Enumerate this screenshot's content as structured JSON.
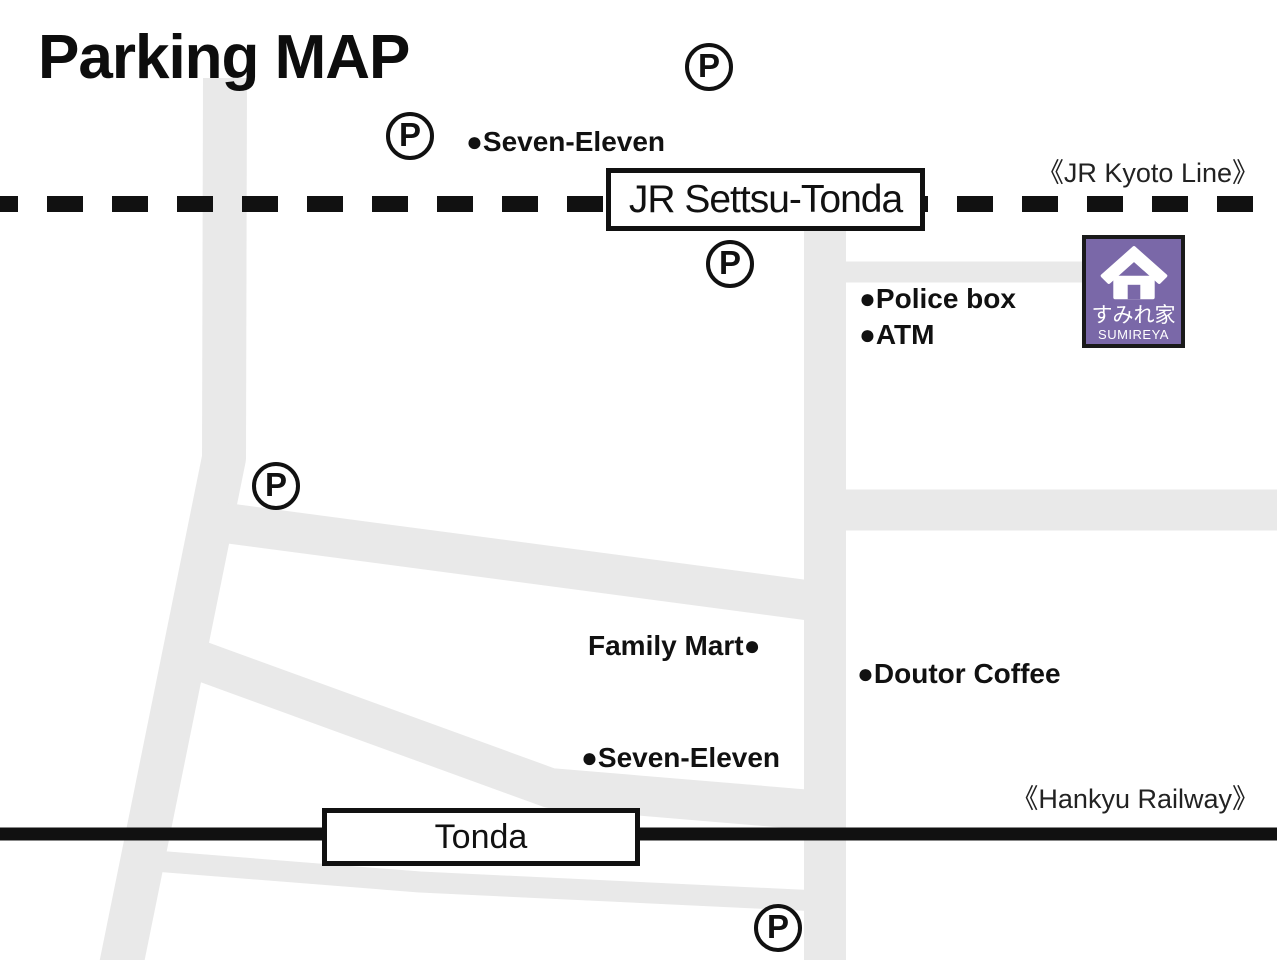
{
  "title": "Parking MAP",
  "jr_line": {
    "name": "《JR Kyoto Line》",
    "station": "JR Settsu-Tonda"
  },
  "hankyu_line": {
    "name": "《Hankyu Railway》",
    "station": "Tonda"
  },
  "parking_letter": "P",
  "landmarks": {
    "seven_eleven_north": "●Seven-Eleven",
    "police_box": "●Police box",
    "atm": "●ATM",
    "family_mart": "Family Mart●",
    "doutor_coffee": "●Doutor Coffee",
    "seven_eleven_south": "●Seven-Eleven"
  },
  "logo": {
    "name_jp": "すみれ家",
    "name_en": "SUMIREYA"
  },
  "colors": {
    "road": "#e9e9e9",
    "railway": "#111111",
    "logo_bg": "#7a68a8",
    "text": "#111111"
  }
}
